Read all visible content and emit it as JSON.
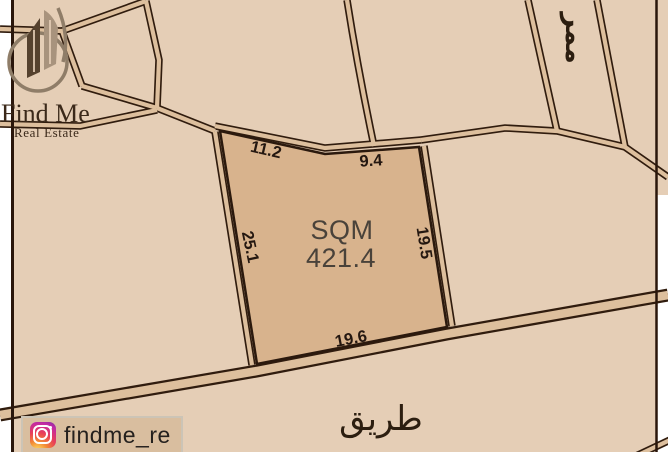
{
  "brand": {
    "name": "Find Me",
    "tagline": "Real Estate"
  },
  "social": {
    "platform": "instagram",
    "handle": "findme_re"
  },
  "plot": {
    "area_label": "SQM",
    "area_value": "421.4",
    "dimensions": {
      "top_left_edge": "11.2",
      "top_right_edge": "9.4",
      "left_edge": "25.1",
      "right_edge": "19.5",
      "bottom_edge": "19.6"
    }
  },
  "map_labels": {
    "road_arabic": "طريق",
    "passage_arabic": "ممر"
  },
  "colors": {
    "background_beige": "#e5ceb6",
    "plot_fill": "#d8b38d",
    "road_casing": "#301c0e",
    "road_fill": "#ddbf9d",
    "border_line": "#2a160b",
    "brand_brown": "#3b291a",
    "logo_dark": "#55412e",
    "logo_taupe": "#a8937d",
    "badge_bg": "#d9be9f"
  }
}
